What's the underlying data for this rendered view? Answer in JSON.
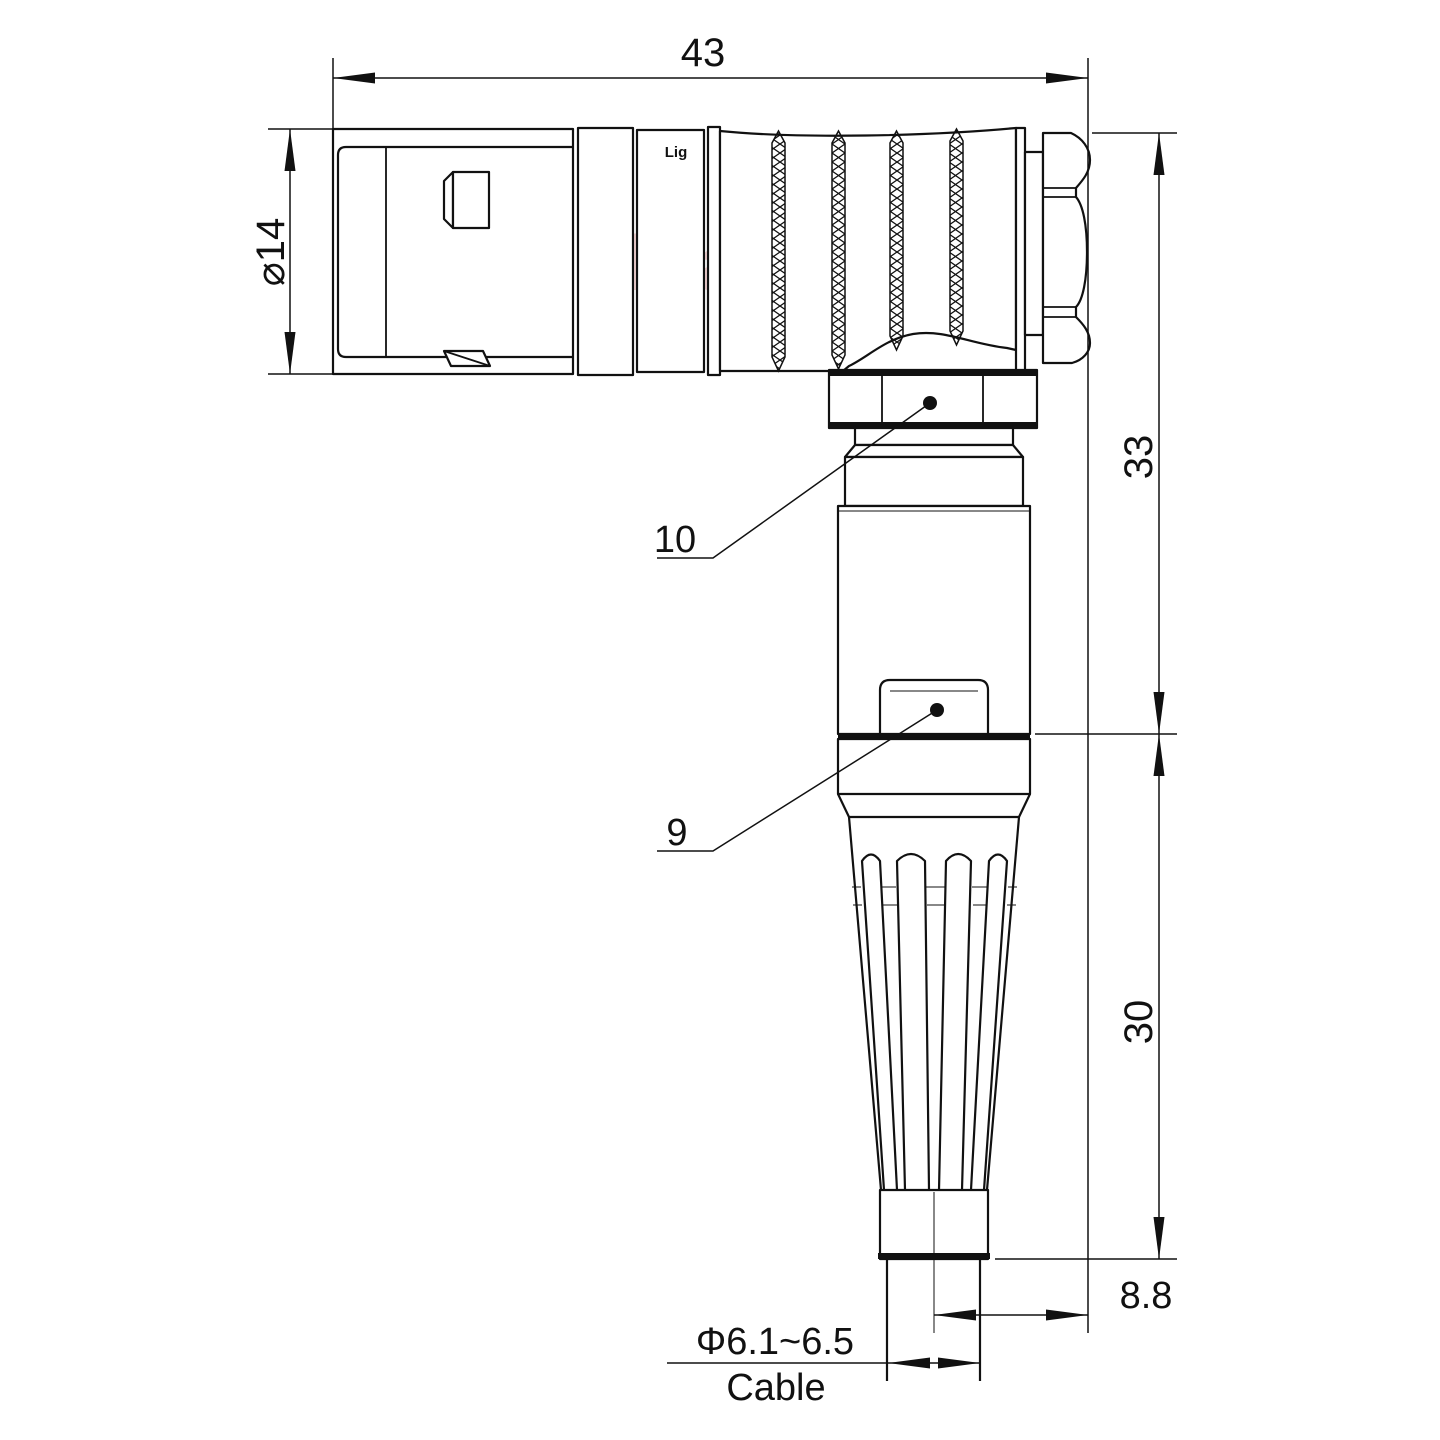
{
  "drawing": {
    "watermark": "Lightany",
    "part_marking": "Lig",
    "dimensions": {
      "overall_length": "43",
      "body_diameter": "⌀14",
      "height_upper": "33",
      "height_lower": "30",
      "cable_offset": "8.8",
      "cable_diameter": "Φ6.1~6.5",
      "cable_label": "Cable"
    },
    "callouts": {
      "coupling_nut": "10",
      "cable_clamp": "9"
    },
    "colors": {
      "line": "#111111",
      "watermark": "#f3bcbc",
      "background": "#ffffff"
    }
  }
}
